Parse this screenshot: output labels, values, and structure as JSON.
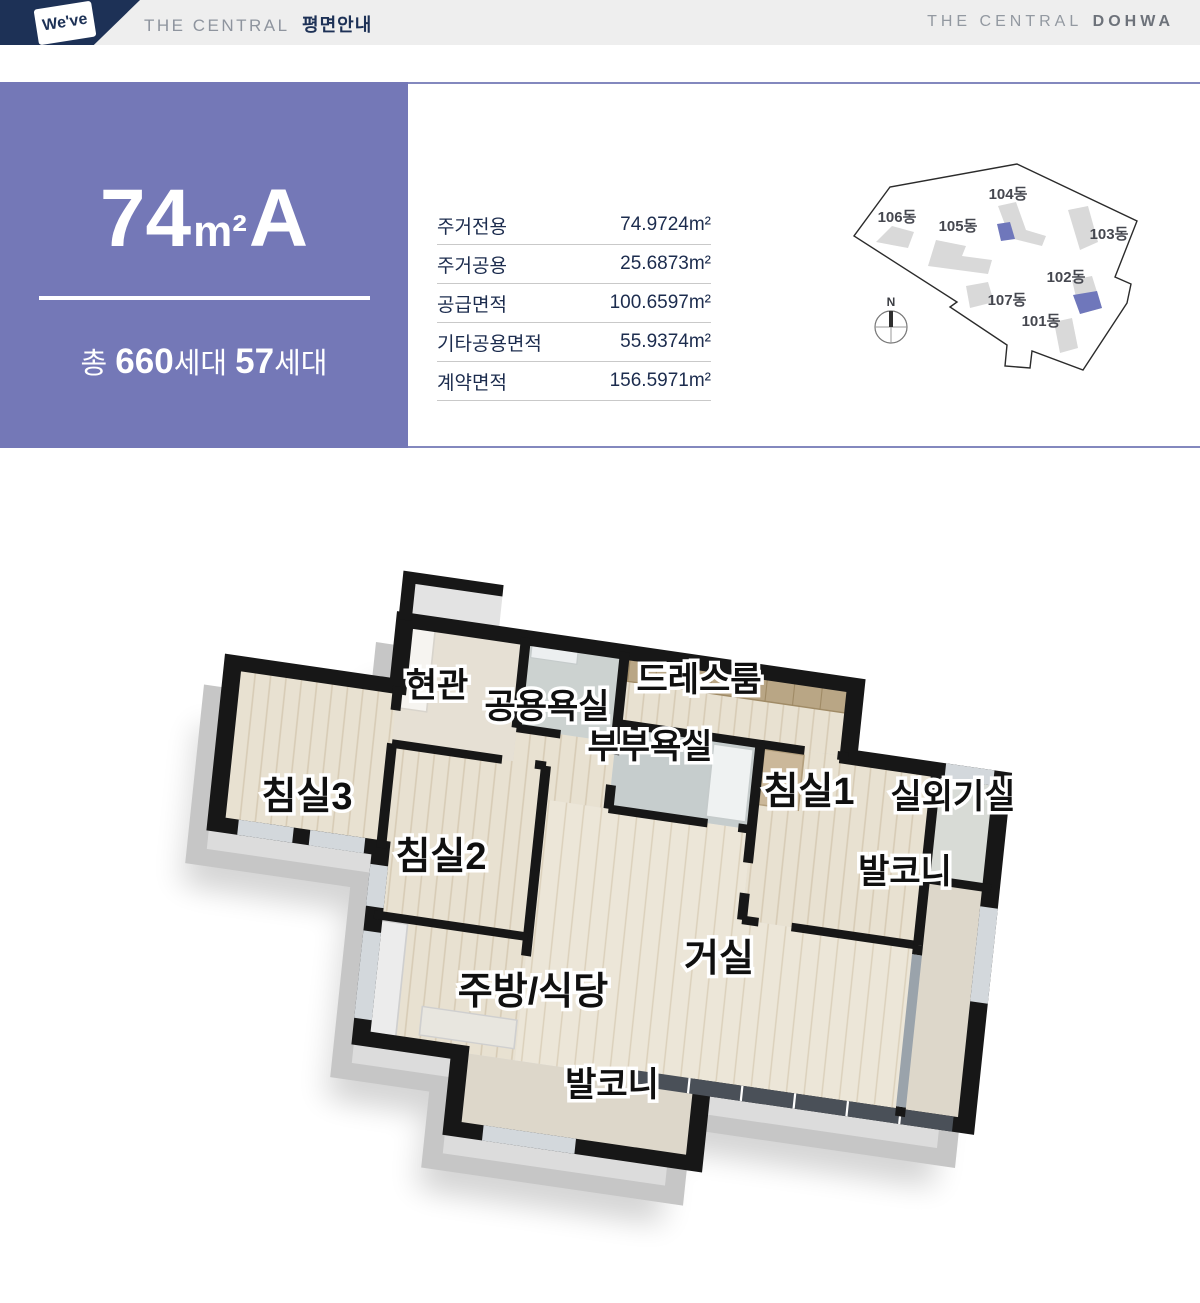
{
  "header": {
    "logo": "We've",
    "left_prefix": "THE CENTRAL",
    "left_title": "평면안내",
    "right_prefix": "THE CENTRAL",
    "right_brand": "DOHWA"
  },
  "unit": {
    "size_number": "74",
    "size_sup": "m²",
    "size_type": "A",
    "households_prefix": "총 ",
    "households_total": "660",
    "households_mid": "세대 ",
    "households_type": "57",
    "households_suffix": "세대"
  },
  "area_table": {
    "rows": [
      {
        "label": "주거전용",
        "value": "74.9724m²"
      },
      {
        "label": "주거공용",
        "value": "25.6873m²"
      },
      {
        "label": "공급면적",
        "value": "100.6597m²"
      },
      {
        "label": "기타공용면적",
        "value": "55.9374m²"
      },
      {
        "label": "계약면적",
        "value": "156.5971m²"
      }
    ]
  },
  "site_map": {
    "compass": "N",
    "buildings": [
      "106동",
      "105동",
      "104동",
      "103동",
      "102동",
      "107동",
      "101동"
    ],
    "highlight_color": "#6f77bb"
  },
  "floor_plan": {
    "rooms": [
      "현관",
      "공용욕실",
      "드레스룸",
      "부부욕실",
      "침실1",
      "실외기실",
      "침실3",
      "침실2",
      "발코니",
      "거실",
      "주방/식당",
      "발코니"
    ]
  },
  "colors": {
    "navy": "#1d3156",
    "purple_panel": "#7478b7",
    "band_gray": "#eeeeee",
    "wall_black": "#171717",
    "wood_floor": "#e8e1d1"
  }
}
